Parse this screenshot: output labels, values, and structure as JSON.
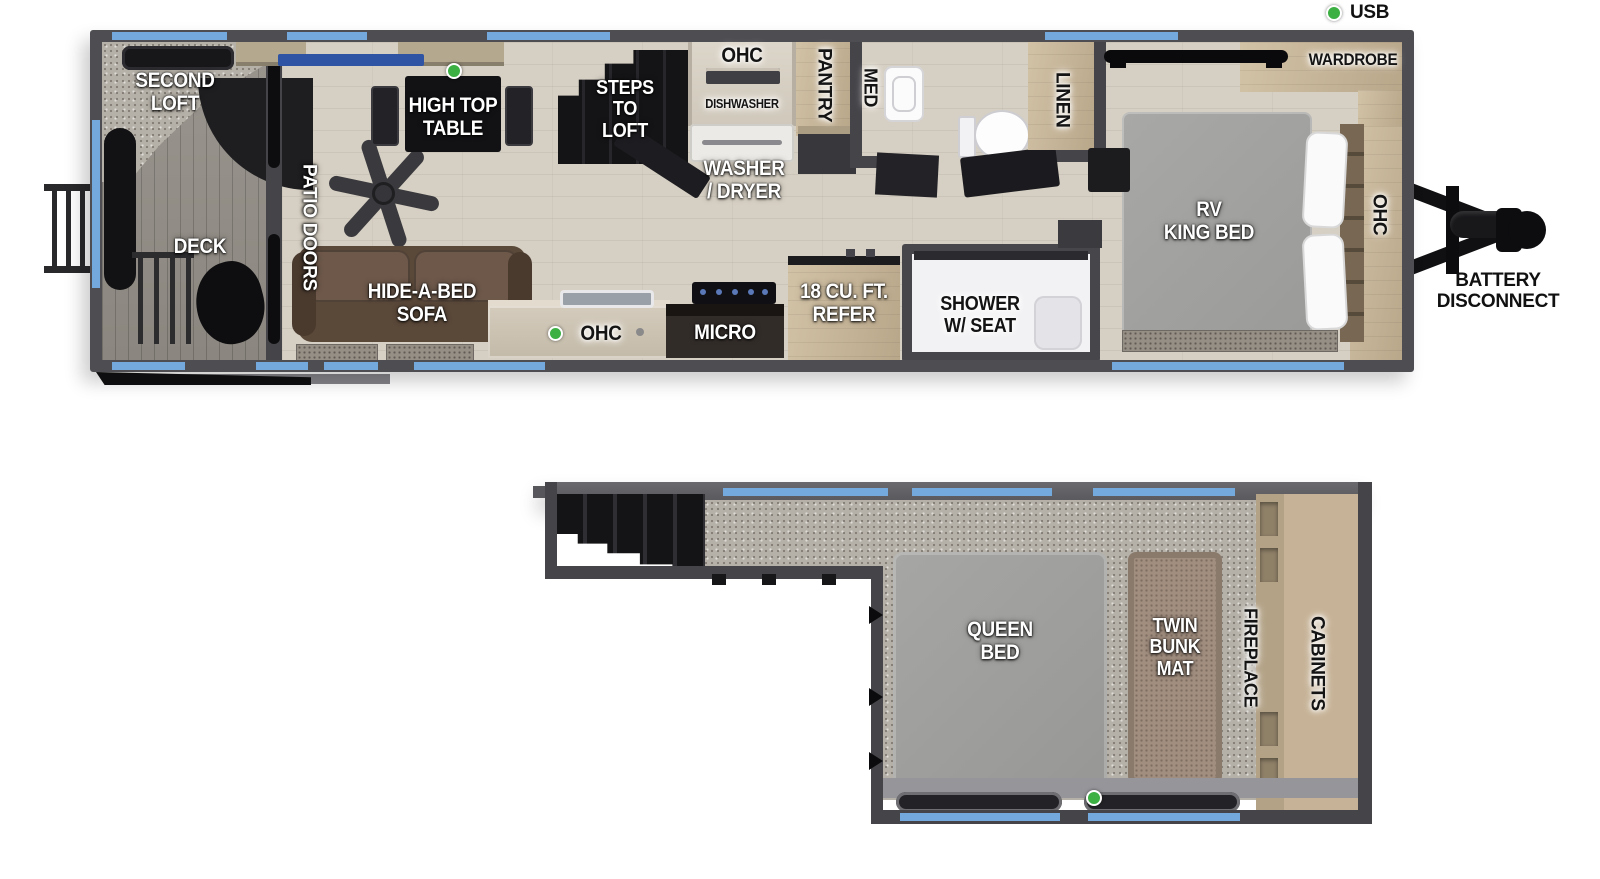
{
  "legend": {
    "usb": "USB"
  },
  "colors": {
    "blue": "#74a9dd",
    "green": "#3cb043",
    "wall": "#4e4e52",
    "carpet": "#b6b1a8",
    "wood": "#d6cfc3"
  },
  "main_floor": {
    "second_loft": "SECOND\nLOFT",
    "deck": "DECK",
    "patio_doors": "PATIO DOORS",
    "high_top_table": "HIGH TOP\nTABLE",
    "steps_to_loft": "STEPS\nTO\nLOFT",
    "ohc_upper": "OHC",
    "dishwasher": "DISHWASHER",
    "washer_dryer": "WASHER\n/ DRYER",
    "pantry": "PANTRY",
    "med": "MED",
    "hide_a_bed_sofa": "HIDE-A-BED\nSOFA",
    "ohc_kitchen": "OHC",
    "micro": "MICRO",
    "refer": "18 CU. FT.\nREFER",
    "shower": "SHOWER\nW/ SEAT",
    "linen": "LINEN",
    "rv_king_bed": "RV\nKING BED",
    "wardrobe": "WARDROBE",
    "ohc_bedroom": "OHC",
    "battery_disconnect": "BATTERY\nDISCONNECT"
  },
  "loft_floor": {
    "queen_bed": "QUEEN\nBED",
    "twin_bunk_mat": "TWIN\nBUNK\nMAT",
    "fireplace": "FIREPLACE",
    "cabinets": "CABINETS"
  }
}
